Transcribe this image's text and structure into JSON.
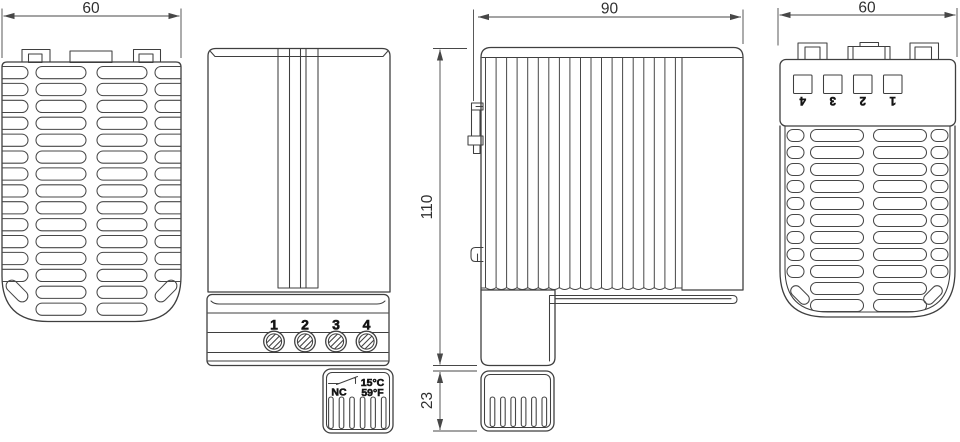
{
  "front_view": {
    "width_dim": "60"
  },
  "side_view": {
    "terminals": [
      "1",
      "2",
      "3",
      "4"
    ],
    "thermostat": {
      "contact_label": "NC",
      "temp_celsius": "15°C",
      "temp_fahrenheit": "59°F"
    }
  },
  "profile_view": {
    "width_dim": "90",
    "height_dim": "110",
    "thermostat_height_dim": "23"
  },
  "back_view": {
    "width_dim": "60",
    "terminals": [
      "4",
      "3",
      "2",
      "1"
    ]
  },
  "colors": {
    "line": "#3f3f3f",
    "dimension": "#474747",
    "text": "#303030",
    "background": "#ffffff"
  }
}
